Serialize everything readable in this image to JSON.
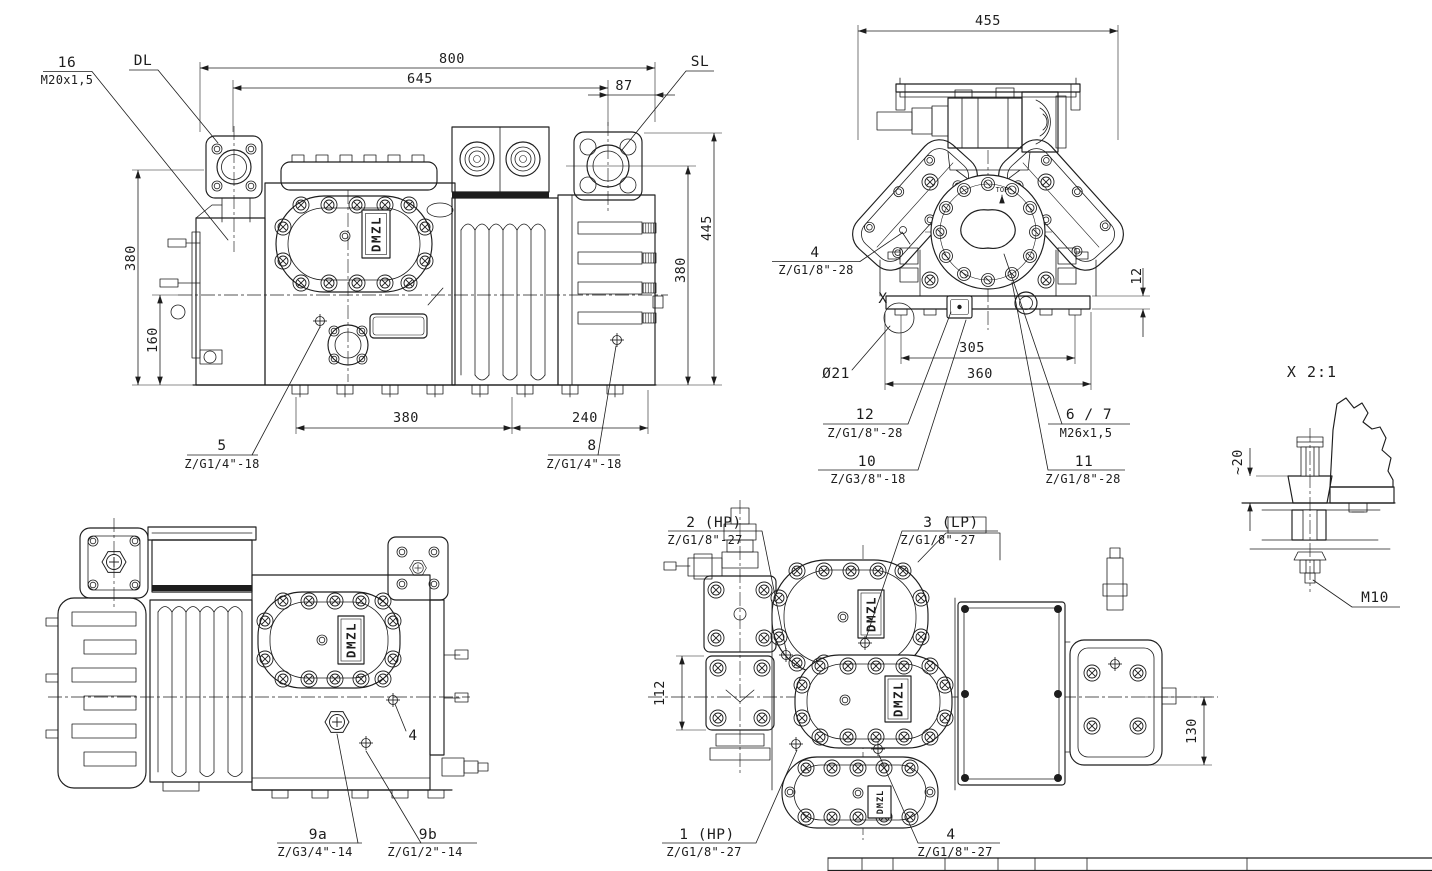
{
  "brand": "DMZL",
  "side_view": {
    "dim_800": "800",
    "dim_645": "645",
    "dim_87": "87",
    "dim_380_left": "380",
    "dim_160": "160",
    "dim_445": "445",
    "dim_380_right": "380",
    "dim_380_bottom": "380",
    "dim_240": "240",
    "label_16_no": "16",
    "label_16_spec": "M20x1,5",
    "label_dl": "DL",
    "label_sl": "SL",
    "label_5_no": "5",
    "label_5_spec": "Z/G1/4\"-18",
    "label_8_no": "8",
    "label_8_spec": "Z/G1/4\"-18"
  },
  "front_view": {
    "dim_455": "455",
    "dim_305": "305",
    "dim_360": "360",
    "dim_12": "12",
    "dia_21": "Ø21",
    "detail_marker": "X",
    "top_marking": "TOP",
    "label_4_no": "4",
    "label_4_spec": "Z/G1/8\"-28",
    "label_12_no": "12",
    "label_12_spec": "Z/G1/8\"-28",
    "label_10_no": "10",
    "label_10_spec": "Z/G3/8\"-18",
    "label_6_7_no": "6 / 7",
    "label_6_7_spec": "M26x1,5",
    "label_11_no": "11",
    "label_11_spec": "Z/G1/8\"-28"
  },
  "detail_x": {
    "title": "X 2:1",
    "dim_20": "~20",
    "thread": "M10"
  },
  "rear_view": {
    "label_4": "4",
    "label_9a_no": "9a",
    "label_9a_spec": "Z/G3/4\"-14",
    "label_9b_no": "9b",
    "label_9b_spec": "Z/G1/2\"-14"
  },
  "top_view": {
    "dim_112": "112",
    "dim_130": "130",
    "label_2_no": "2 (HP)",
    "label_2_spec": "Z/G1/8\"-27",
    "label_3_no": "3 (LP)",
    "label_3_spec": "Z/G1/8\"-27",
    "label_1_no": "1 (HP)",
    "label_1_spec": "Z/G1/8\"-27",
    "label_4_no": "4",
    "label_4_spec": "Z/G1/8\"-27"
  }
}
